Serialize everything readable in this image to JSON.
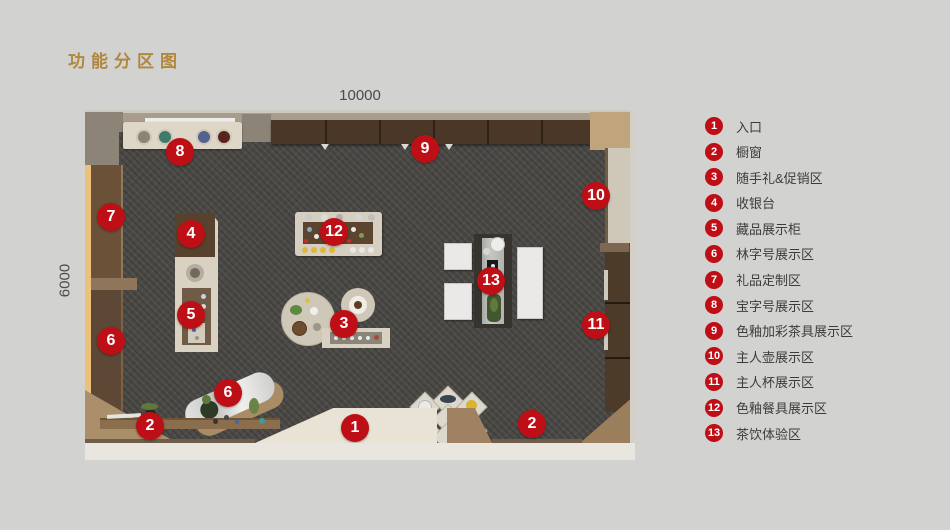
{
  "title": {
    "text": "功能分区图",
    "color": "#b1873e"
  },
  "plan": {
    "dimension_top": "10000",
    "dimension_left": "6000",
    "marker_color": "#bf0f16",
    "floor_color": "#4d4b47",
    "markers": [
      {
        "num": "8",
        "x": 95,
        "y": 42
      },
      {
        "num": "9",
        "x": 340,
        "y": 39
      },
      {
        "num": "7",
        "x": 26,
        "y": 107
      },
      {
        "num": "4",
        "x": 106,
        "y": 124
      },
      {
        "num": "12",
        "x": 249,
        "y": 122
      },
      {
        "num": "10",
        "x": 511,
        "y": 86
      },
      {
        "num": "5",
        "x": 106,
        "y": 205
      },
      {
        "num": "3",
        "x": 259,
        "y": 214
      },
      {
        "num": "13",
        "x": 406,
        "y": 171
      },
      {
        "num": "6",
        "x": 26,
        "y": 231
      },
      {
        "num": "11",
        "x": 511,
        "y": 215
      },
      {
        "num": "6",
        "x": 143,
        "y": 283
      },
      {
        "num": "2",
        "x": 65,
        "y": 316
      },
      {
        "num": "1",
        "x": 270,
        "y": 318
      },
      {
        "num": "2",
        "x": 447,
        "y": 314
      }
    ]
  },
  "legend": {
    "items": [
      {
        "num": "1",
        "label": "入口"
      },
      {
        "num": "2",
        "label": "橱窗"
      },
      {
        "num": "3",
        "label": "随手礼&促销区"
      },
      {
        "num": "4",
        "label": "收银台"
      },
      {
        "num": "5",
        "label": "藏品展示柜"
      },
      {
        "num": "6",
        "label": "林字号展示区"
      },
      {
        "num": "7",
        "label": "礼品定制区"
      },
      {
        "num": "8",
        "label": "宝字号展示区"
      },
      {
        "num": "9",
        "label": "色釉加彩茶具展示区"
      },
      {
        "num": "10",
        "label": "主人壶展示区"
      },
      {
        "num": "11",
        "label": "主人杯展示区"
      },
      {
        "num": "12",
        "label": "色釉餐具展示区"
      },
      {
        "num": "13",
        "label": "茶饮体验区"
      }
    ]
  }
}
